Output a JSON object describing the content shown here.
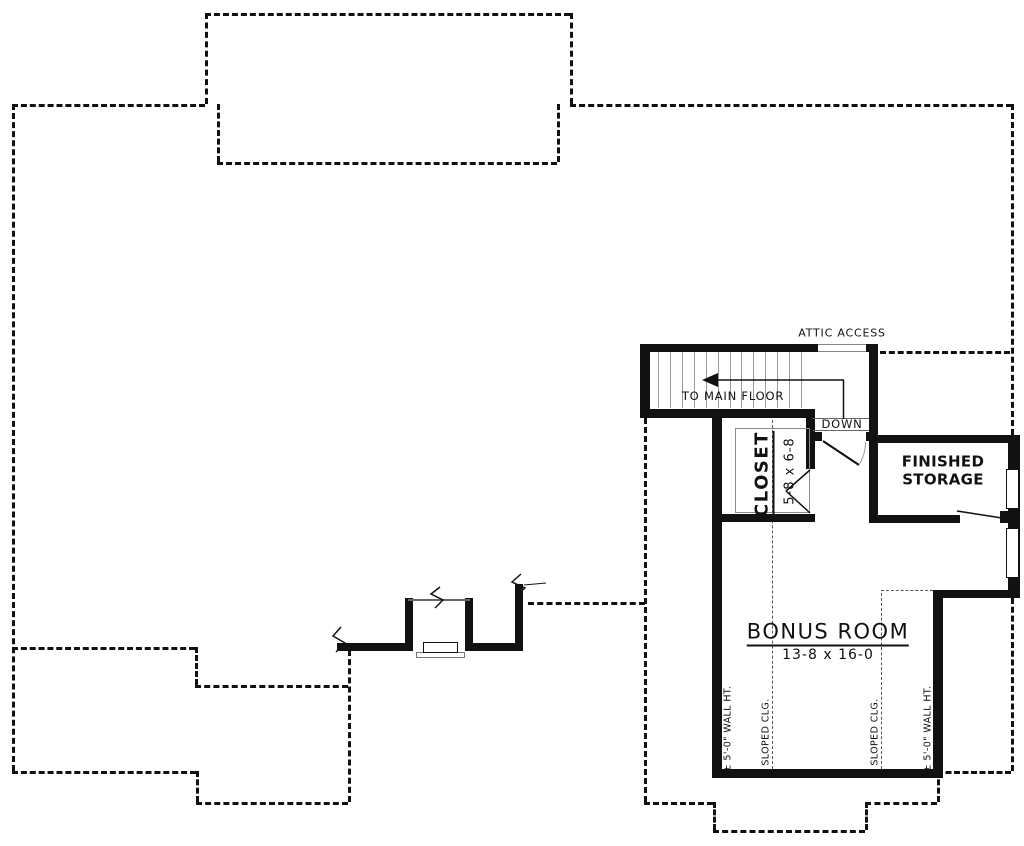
{
  "plan": {
    "title": "second floor bonus room plan",
    "labels": {
      "attic_access": "ATTIC ACCESS",
      "to_main_floor": "TO MAIN FLOOR",
      "down": "DOWN",
      "closet_name": "CLOSET",
      "closet_dims": "5-8 x 6-8",
      "storage_name": "FINISHED STORAGE",
      "bonus_name": "BONUS ROOM",
      "bonus_dims": "13-8 x 16-0",
      "wall_height_left": "± 5'-0\" WALL HT.",
      "sloped_clg_left": "SLOPED CLG.",
      "sloped_clg_right": "SLOPED CLG.",
      "wall_height_right": "± 5'-0\" WALL HT."
    },
    "stairs": {
      "tread_count": 13
    },
    "colors": {
      "wall": "#111111",
      "roof_dash": "#111111",
      "sloped_dash": "#555555",
      "tread": "#9a9a9a",
      "background": "#ffffff"
    }
  }
}
